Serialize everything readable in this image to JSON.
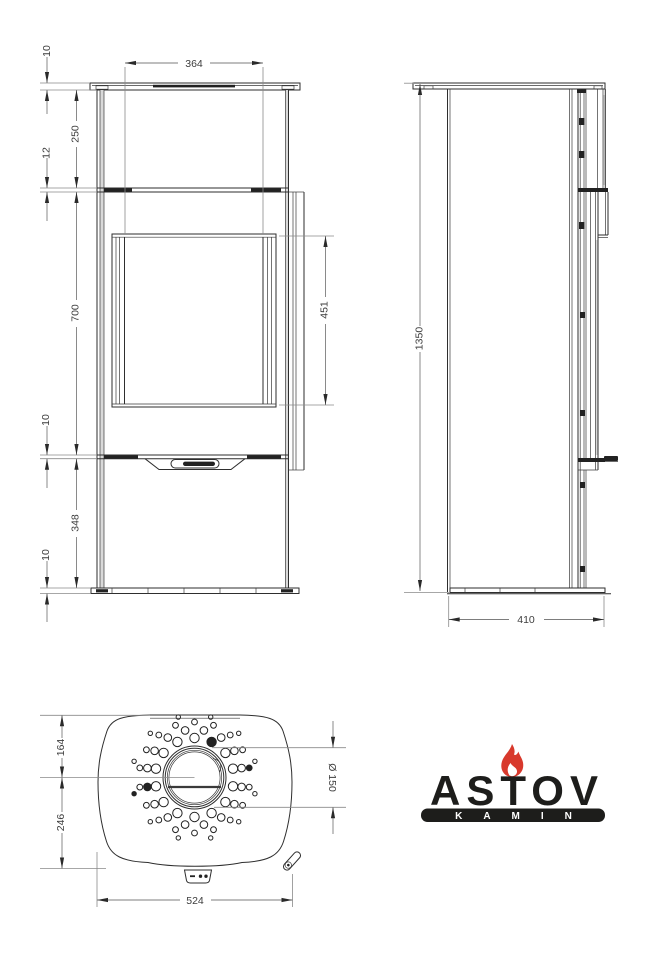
{
  "drawing_title": "stove-technical-drawing",
  "dims": {
    "front": {
      "top_plate": "10",
      "glass_width": "364",
      "top_section": "250",
      "shelf": "12",
      "door_section": "700",
      "glass_height": "451",
      "gap": "10",
      "base_section": "348",
      "base_plate": "10"
    },
    "side": {
      "height": "1350",
      "depth": "410"
    },
    "top": {
      "back_to_flue": "164",
      "flue_to_front": "246",
      "width": "524",
      "flue_diameter": "Ø 150"
    }
  },
  "logo": {
    "brand": "ASTOV",
    "tagline": "KAMIN",
    "flame_color": "#d8392c",
    "bar_color": "#1d1d1b",
    "text_color": "#1d1d1b",
    "tagline_color": "#ffffff"
  },
  "perforation": {
    "cx": 194.5,
    "cy": 777.5,
    "rings": [
      {
        "r": 39.5,
        "count": 14,
        "hole_r": 4.7,
        "start": -90,
        "filled": [
          1
        ]
      },
      {
        "r": 48,
        "count": 16,
        "hole_r": 3.8,
        "start": -78.75,
        "filled": [
          11
        ]
      },
      {
        "r": 55.5,
        "count": 18,
        "hole_r": 2.9,
        "start": -90,
        "filled": [
          4
        ]
      },
      {
        "r": 62.5,
        "count": 12,
        "hole_r": 2.2,
        "start": -75,
        "filled": [
          8
        ]
      }
    ]
  }
}
